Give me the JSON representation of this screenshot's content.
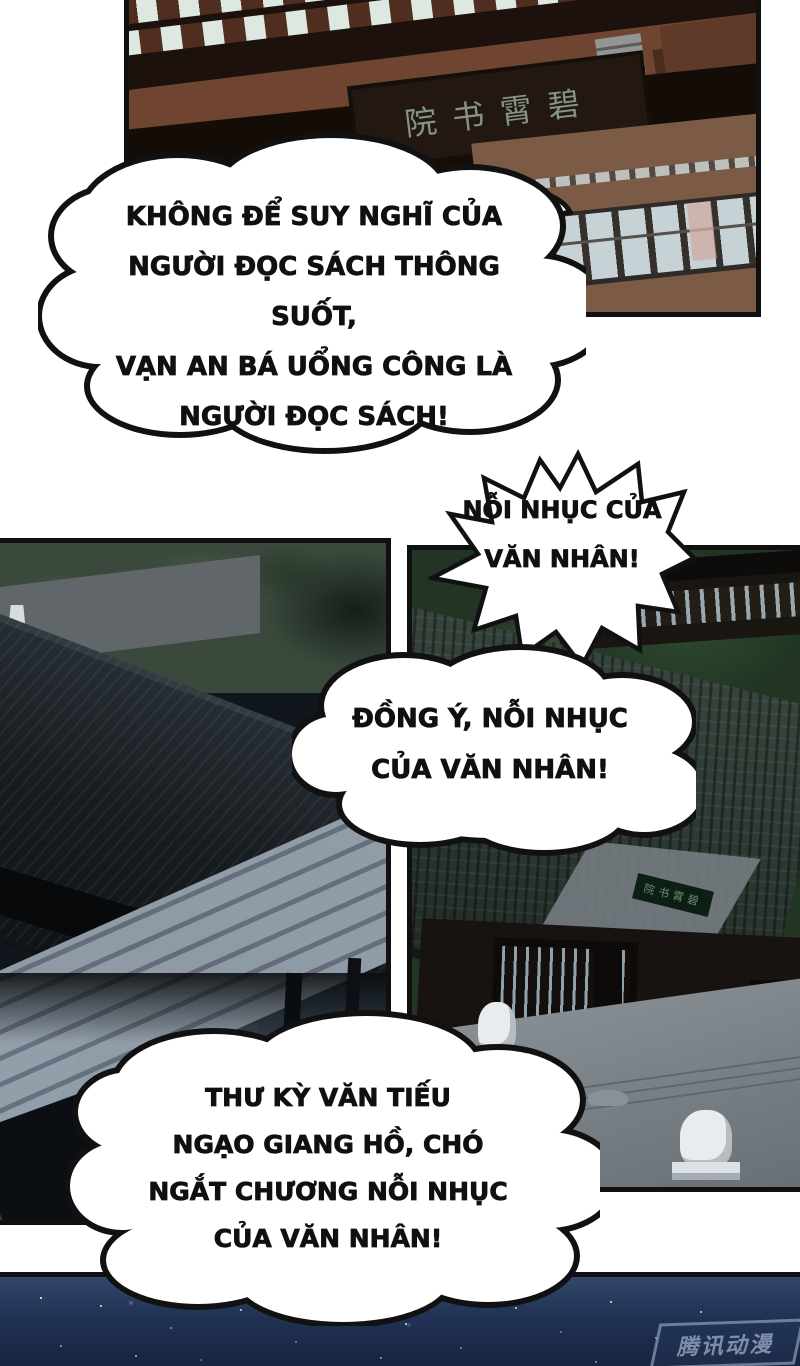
{
  "page": {
    "background": "#ffffff",
    "ink": "#111111"
  },
  "bubbles": {
    "b1": {
      "style": "cloud",
      "lines": [
        "KHÔNG ĐỂ SUY NGHĨ CỦA",
        "NGƯỜI ĐỌC SÁCH THÔNG SUỐT,",
        "VẠN AN BÁ UỔNG CÔNG LÀ",
        "NGƯỜI ĐỌC SÁCH!"
      ]
    },
    "b2": {
      "style": "burst",
      "lines": [
        "NỖI NHỤC CỦA",
        "VĂN NHÂN!"
      ]
    },
    "b3": {
      "style": "cloud",
      "lines": [
        "ĐỒNG Ý, NỖI NHỤC",
        "CỦA VĂN NHÂN!"
      ]
    },
    "b4": {
      "style": "cloud",
      "lines": [
        "THƯ KỲ VĂN TIẾU",
        "NGẠO GIANG HỒ, CHÓ",
        "NGẮT CHƯƠNG NỖI NHỤC",
        "CỦA VĂN NHÂN!"
      ]
    }
  },
  "panels": {
    "top": {
      "sign_text": "院书霄碧",
      "description": "night facade of the academy with plaque and lit windows"
    },
    "mid_left": {
      "description": "dark tiled roof over a stone courtyard with plank walkway and lantern"
    },
    "mid_right": {
      "sign_text": "院书霄碧",
      "description": "academy gate among trees with stone lions on a grey terrace"
    },
    "bottom": {
      "description": "starry night sky strip",
      "watermark_text": "腾讯动漫"
    }
  },
  "colors": {
    "panel_border": "#101010",
    "night_sky": "#203153",
    "roof_dark": "#171c20",
    "roof_green": "#2b3731",
    "stone": "#7a8288",
    "wood_red": "#6f4430",
    "checker_light": "#dde8e1",
    "tree_green": "#49663f"
  }
}
